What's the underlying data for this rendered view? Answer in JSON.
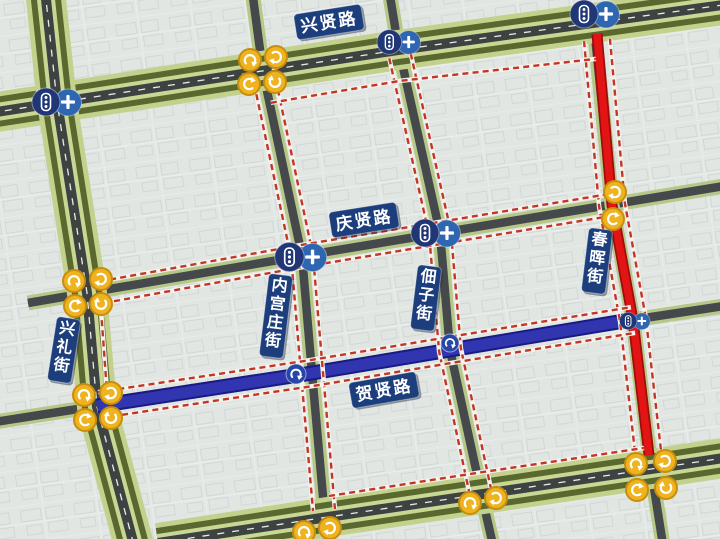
{
  "canvas": {
    "width": 720,
    "height": 539
  },
  "colors": {
    "background": "#e1e6e3",
    "building_line": "#c6cecb",
    "boulevard_verge": "#c3d18c",
    "boulevard_tree": "#59682e",
    "boulevard_inner": "#cad794",
    "asphalt_dark": "#3d4341",
    "street_edge": "#b6c887",
    "street_asphalt": "#45494b",
    "closed_route": "#e31414",
    "closed_route_edge": "#9e0d0d",
    "detour_route": "#3136b0",
    "detour_route_edge": "#181b86",
    "boundary_dash": "#c23527",
    "boundary_underlay": "#f3f2ed",
    "signal_dark_circle": "#203677",
    "signal_light_circle": "#2e66b2",
    "turn_badge": "#eeb31f",
    "turn_badge_border": "#c78d0e",
    "label_bg": "#1c3e7c",
    "label_text": "#ffffff",
    "center_dash": "#e9eae4"
  },
  "roads": {
    "boulevards": [
      {
        "id": "xingxian-road",
        "points": [
          [
            -10,
            113
          ],
          [
            398,
            50
          ],
          [
            730,
            4
          ]
        ]
      },
      {
        "id": "xingli-street",
        "points": [
          [
            45,
            -10
          ],
          [
            57,
            102
          ],
          [
            87,
            293
          ],
          [
            97,
            407
          ],
          [
            135,
            549
          ]
        ]
      },
      {
        "id": "south-boulevard",
        "points": [
          [
            158,
            543
          ],
          [
            328,
            517
          ],
          [
            483,
            494
          ],
          [
            651,
            469
          ],
          [
            730,
            457
          ]
        ]
      }
    ],
    "streets": [
      {
        "id": "qingxian-road",
        "points": [
          [
            28,
            303
          ],
          [
            302,
            256
          ],
          [
            440,
            233
          ],
          [
            730,
            185
          ]
        ]
      },
      {
        "id": "hexian-road",
        "points": [
          [
            -5,
            422
          ],
          [
            97,
            406
          ],
          [
            312,
            373
          ],
          [
            450,
            350
          ],
          [
            638,
            319
          ],
          [
            730,
            305
          ]
        ]
      },
      {
        "id": "neigongzhuang-street",
        "points": [
          [
            252,
            -10
          ],
          [
            263,
            72
          ],
          [
            302,
            256
          ],
          [
            312,
            373
          ],
          [
            325,
            519
          ],
          [
            330,
            545
          ]
        ]
      },
      {
        "id": "dianzi-street",
        "points": [
          [
            389,
            -10
          ],
          [
            398,
            45
          ],
          [
            440,
            233
          ],
          [
            450,
            350
          ],
          [
            482,
            497
          ],
          [
            493,
            545
          ]
        ]
      },
      {
        "id": "chunhui-street",
        "points": [
          [
            594,
            26
          ],
          [
            612,
            205
          ],
          [
            633,
            320
          ],
          [
            651,
            469
          ],
          [
            663,
            545
          ]
        ]
      }
    ]
  },
  "routes": {
    "closed_segment": {
      "id": "chunhui-closed-route",
      "points": [
        [
          597,
          34
        ],
        [
          612,
          205
        ],
        [
          633,
          320
        ],
        [
          649,
          455
        ]
      ]
    },
    "detour_segment": {
      "id": "hexian-detour-route",
      "points": [
        [
          97,
          406
        ],
        [
          312,
          373
        ],
        [
          450,
          350
        ],
        [
          636,
          319
        ]
      ]
    }
  },
  "boundaries": [
    {
      "id": "boundary-neigongzhuang",
      "points": [
        [
          265,
          82
        ],
        [
          302,
          256
        ],
        [
          312,
          373
        ],
        [
          324,
          510
        ]
      ],
      "offsets": [
        -11,
        11
      ]
    },
    {
      "id": "boundary-dianzi",
      "points": [
        [
          400,
          56
        ],
        [
          440,
          233
        ],
        [
          450,
          350
        ],
        [
          480,
          490
        ]
      ],
      "offsets": [
        -11,
        11
      ]
    },
    {
      "id": "boundary-chunhui",
      "points": [
        [
          597,
          40
        ],
        [
          612,
          205
        ],
        [
          633,
          320
        ],
        [
          649,
          460
        ]
      ],
      "offsets": [
        -13,
        13
      ]
    },
    {
      "id": "boundary-qingxian",
      "points": [
        [
          92,
          294
        ],
        [
          302,
          256
        ],
        [
          440,
          233
        ],
        [
          616,
          204
        ]
      ],
      "offsets": [
        -11,
        11
      ]
    },
    {
      "id": "boundary-hexian",
      "points": [
        [
          100,
          405
        ],
        [
          312,
          373
        ],
        [
          450,
          350
        ],
        [
          633,
          320
        ]
      ],
      "offsets": [
        -13,
        13
      ]
    },
    {
      "id": "boundary-xingxian-south",
      "points": [
        [
          268,
          86
        ],
        [
          398,
          64
        ],
        [
          594,
          42
        ]
      ],
      "offsets": [
        17
      ]
    },
    {
      "id": "boundary-southblvd-north",
      "points": [
        [
          329,
          496
        ],
        [
          483,
          472
        ],
        [
          644,
          448
        ]
      ],
      "offsets": [
        0
      ]
    },
    {
      "id": "boundary-xingli-east",
      "points": [
        [
          101,
          310
        ],
        [
          107,
          392
        ]
      ],
      "offsets": [
        0
      ]
    }
  ],
  "labels": [
    {
      "id": "xingxian",
      "text": "兴贤路",
      "x": 329,
      "y": 22,
      "orient": "h",
      "rotate": -9
    },
    {
      "id": "qingxian",
      "text": "庆贤路",
      "x": 364,
      "y": 220,
      "orient": "h",
      "rotate": -9
    },
    {
      "id": "hexian",
      "text": "贺贤路",
      "x": 384,
      "y": 390,
      "orient": "h",
      "rotate": -10
    },
    {
      "id": "xingli",
      "text": "兴礼街",
      "x": 64,
      "y": 350,
      "orient": "v",
      "rotate": 9
    },
    {
      "id": "neigongzhuang",
      "text": "内宫庄街",
      "x": 276,
      "y": 316,
      "orient": "v",
      "rotate": 7
    },
    {
      "id": "dianzi",
      "text": "佃子街",
      "x": 426,
      "y": 298,
      "orient": "v",
      "rotate": 7
    },
    {
      "id": "chunhui",
      "text": "春晖街",
      "x": 597,
      "y": 261,
      "orient": "v",
      "rotate": 7
    }
  ],
  "signal_icons": [
    {
      "id": "signal-xingxian-xingli",
      "x": 57,
      "y": 102,
      "scale": 1.0
    },
    {
      "id": "signal-xingxian-dianzi",
      "x": 399,
      "y": 42,
      "scale": 0.88
    },
    {
      "id": "signal-xingxian-chunhui",
      "x": 595,
      "y": 14,
      "scale": 1.0
    },
    {
      "id": "signal-qingxian-neigongzhuang",
      "x": 301,
      "y": 257,
      "scale": 1.05
    },
    {
      "id": "signal-qingxian-dianzi",
      "x": 436,
      "y": 233,
      "scale": 1.0
    },
    {
      "id": "signal-hexian-chunhui",
      "x": 635,
      "y": 321,
      "scale": 0.62
    }
  ],
  "detour_turn_icons": [
    {
      "id": "turn-hexian-neigongzhuang",
      "x": 296,
      "y": 374,
      "r": 10
    },
    {
      "id": "turn-hexian-dianzi",
      "x": 450,
      "y": 343,
      "r": 9
    }
  ],
  "junction_clusters": [
    {
      "id": "junction-xingxian-neigongzhuang",
      "x": 263,
      "y": 72,
      "circles": [
        [
          -13,
          -12,
          0
        ],
        [
          13,
          -15,
          90
        ],
        [
          -14,
          12,
          270
        ],
        [
          12,
          10,
          180
        ]
      ]
    },
    {
      "id": "junction-qingxian-xingli",
      "x": 87,
      "y": 293,
      "circles": [
        [
          -13,
          -12,
          0
        ],
        [
          14,
          -14,
          90
        ],
        [
          -12,
          13,
          270
        ],
        [
          14,
          11,
          180
        ]
      ]
    },
    {
      "id": "junction-hexian-xingli",
      "x": 97,
      "y": 407,
      "circles": [
        [
          -13,
          -12,
          0
        ],
        [
          14,
          -14,
          90
        ],
        [
          -12,
          13,
          270
        ],
        [
          14,
          11,
          180
        ]
      ]
    },
    {
      "id": "junction-southblvd-chunhui",
      "x": 651,
      "y": 477,
      "circles": [
        [
          -15,
          -13,
          0
        ],
        [
          14,
          -16,
          90
        ],
        [
          -14,
          13,
          270
        ],
        [
          15,
          11,
          180
        ]
      ]
    },
    {
      "id": "junction-qingxian-chunhui",
      "x": 614,
      "y": 205,
      "circles": [
        [
          1,
          -13,
          90
        ],
        [
          -1,
          14,
          270
        ]
      ]
    },
    {
      "id": "junction-southblvd-neigongzhuang",
      "x": 317,
      "y": 530,
      "circles": [
        [
          -13,
          2,
          0
        ],
        [
          13,
          -2,
          90
        ]
      ]
    },
    {
      "id": "junction-southblvd-dianzi",
      "x": 483,
      "y": 500,
      "circles": [
        [
          -13,
          3,
          0
        ],
        [
          13,
          -2,
          90
        ]
      ]
    }
  ]
}
